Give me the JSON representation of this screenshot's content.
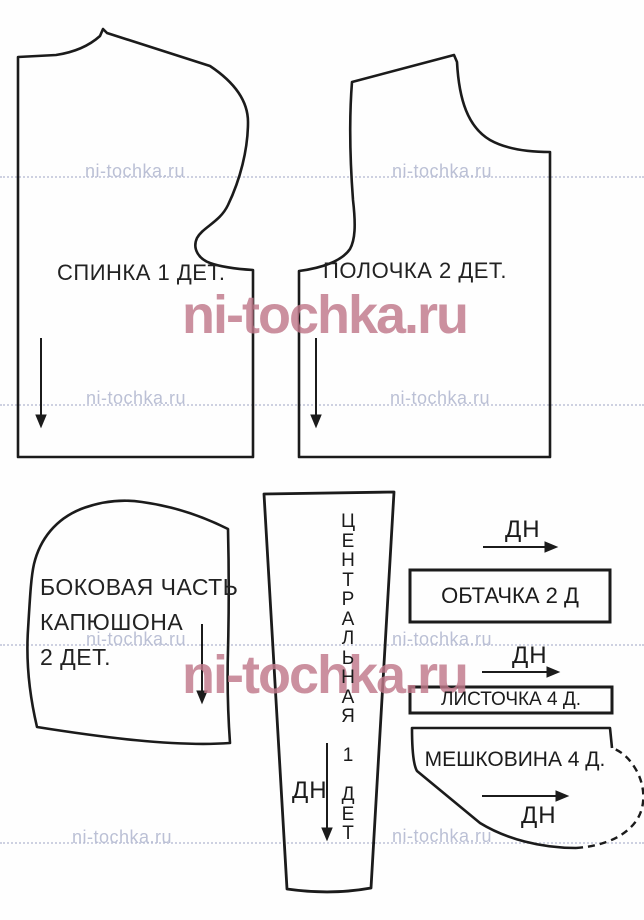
{
  "watermark": {
    "text": "ni-tochka.ru"
  },
  "pieces": {
    "back": {
      "label": "СПИНКА 1 ДЕТ."
    },
    "front": {
      "label": "ПОЛОЧКА 2 ДЕТ."
    },
    "hood_side": {
      "label": "БОКОВАЯ ЧАСТЬ\nКАПЮШОНА\n2 ДЕТ."
    },
    "hood_center": {
      "label": "Ц\nЕ\nН\nТ\nР\nА\nЛ\nЬ\nН\nА\nЯ\n\n1\n\nД\nЕ\nТ",
      "grain": "ДН"
    },
    "facing": {
      "label": "ОБТАЧКА 2 Д",
      "grain": "ДН"
    },
    "welt": {
      "label": "ЛИСТОЧКА 4 Д.",
      "grain": "ДН"
    },
    "pocket_bag": {
      "label": "МЕШКОВИНА 4 Д.",
      "grain": "ДН"
    }
  },
  "colors": {
    "outline": "#1b1b1b",
    "watermark_big": "#c0798b",
    "watermark_small": "#b4bad1"
  }
}
